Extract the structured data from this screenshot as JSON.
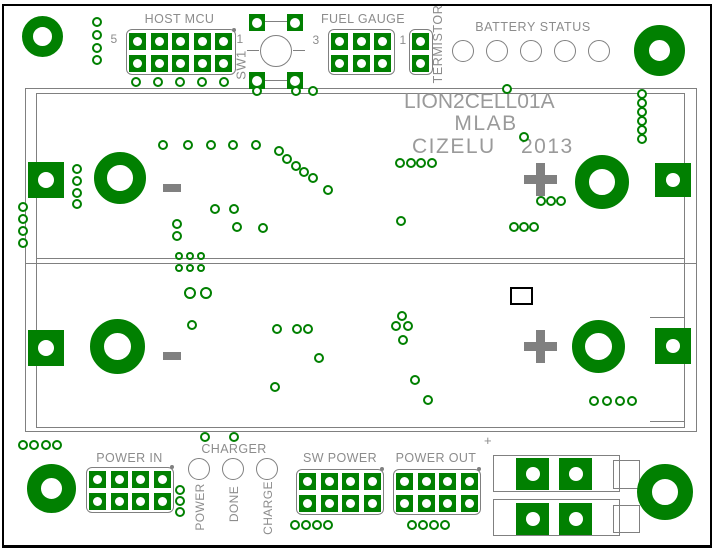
{
  "title_block": {
    "line1": "LION2CELL01A",
    "line2": "MLAB",
    "line3_name": "CIZELU",
    "line3_year": "2013"
  },
  "sections": {
    "host_mcu": {
      "label": "HOST MCU",
      "pin_left": "5",
      "pin_right": "1"
    },
    "fuel_gauge": {
      "label": "FUEL GAUGE",
      "pin_left": "3",
      "pin_right": "1"
    },
    "termistor": {
      "label": "TERMISTOR"
    },
    "switch": {
      "label": "SW1"
    },
    "battery_status": {
      "label": "BATTERY STATUS"
    },
    "charger": {
      "label": "CHARGER",
      "led_labels": [
        "POWER",
        "DONE",
        "CHARGE"
      ]
    },
    "power_in": {
      "label": "POWER IN"
    },
    "sw_power": {
      "label": "SW POWER"
    },
    "power_out": {
      "label": "POWER OUT"
    },
    "terminal": {
      "polarity": "+"
    }
  },
  "colors": {
    "copper": "#018001",
    "silkscreen": "#808080",
    "label_text": "#8c8c8c",
    "title_text": "#9a9a9a",
    "outline": "#000000"
  },
  "pcb": {
    "rects": [
      {
        "n": "battery-holder-outer",
        "x": 25,
        "y": 88,
        "w": 672,
        "h": 344
      },
      {
        "n": "battery-holder-inner",
        "x": 36,
        "y": 93,
        "w": 649,
        "h": 335
      },
      {
        "n": "terminal-block-row1",
        "x": 493,
        "y": 455,
        "w": 127,
        "h": 37
      },
      {
        "n": "terminal-block-row2",
        "x": 493,
        "y": 499,
        "w": 127,
        "h": 37
      },
      {
        "n": "terminal-tab-row1",
        "x": 613,
        "y": 460,
        "w": 27,
        "h": 29
      },
      {
        "n": "terminal-tab-row2",
        "x": 613,
        "y": 505,
        "w": 27,
        "h": 28
      },
      {
        "n": "component-outline",
        "x": 510,
        "y": 287,
        "w": 23,
        "h": 18,
        "c": "#000000",
        "lw": 2
      }
    ],
    "lines": [
      [
        36,
        258,
        649,
        1
      ],
      [
        25,
        263,
        672,
        1
      ],
      [
        650,
        317,
        34,
        1
      ],
      [
        650,
        421,
        34,
        1
      ],
      [
        265,
        21,
        24,
        1
      ],
      [
        265,
        80,
        24,
        1
      ],
      [
        247,
        50,
        12,
        1
      ],
      [
        293,
        50,
        12,
        1
      ]
    ],
    "circles": [
      {
        "n": "sw1-button",
        "cx": 276,
        "cy": 51,
        "r": 16
      },
      {
        "n": "battery-status-led",
        "cx": 463,
        "cy": 51,
        "r": 11
      },
      {
        "n": "battery-status-led",
        "cx": 497,
        "cy": 51,
        "r": 11
      },
      {
        "n": "battery-status-led",
        "cx": 531,
        "cy": 51,
        "r": 11
      },
      {
        "n": "battery-status-led",
        "cx": 565,
        "cy": 51,
        "r": 11
      },
      {
        "n": "battery-status-led",
        "cx": 599,
        "cy": 51,
        "r": 11
      },
      {
        "n": "charger-led-power",
        "cx": 199,
        "cy": 469,
        "r": 11
      },
      {
        "n": "charger-led-done",
        "cx": 233,
        "cy": 469,
        "r": 11
      },
      {
        "n": "charger-led-charge",
        "cx": 267,
        "cy": 469,
        "r": 11
      }
    ],
    "rings": [
      {
        "n": "mount-hole",
        "cx": 43,
        "cy": 37,
        "r": 21,
        "hole": 19
      },
      {
        "n": "mount-hole",
        "cx": 660,
        "cy": 51,
        "r": 26,
        "hole": 21
      },
      {
        "n": "mount-hole",
        "cx": 52,
        "cy": 489,
        "r": 25,
        "hole": 21
      },
      {
        "n": "mount-hole",
        "cx": 665,
        "cy": 492,
        "r": 28,
        "hole": 26
      },
      {
        "n": "battery-contact-ring",
        "cx": 120,
        "cy": 178,
        "r": 26,
        "hole": 26
      },
      {
        "n": "battery-contact-ring",
        "cx": 118,
        "cy": 347,
        "r": 28,
        "hole": 27
      },
      {
        "n": "battery-contact-ring",
        "cx": 602,
        "cy": 182,
        "r": 27,
        "hole": 26
      },
      {
        "n": "battery-contact-ring",
        "cx": 599,
        "cy": 347,
        "r": 27,
        "hole": 27
      }
    ],
    "square_pads": [
      {
        "n": "battery1-neg-pad",
        "x": 28,
        "y": 162,
        "w": 36,
        "h": 36,
        "hole": 16
      },
      {
        "n": "battery2-neg-pad",
        "x": 28,
        "y": 330,
        "w": 36,
        "h": 36,
        "hole": 16
      },
      {
        "n": "battery1-pos-pad",
        "x": 655,
        "y": 163,
        "w": 36,
        "h": 34,
        "hole": 14
      },
      {
        "n": "battery2-pos-pad",
        "x": 655,
        "y": 328,
        "w": 36,
        "h": 36,
        "hole": 14
      },
      {
        "n": "sw1-pad",
        "x": 249,
        "y": 14,
        "w": 16,
        "h": 17,
        "hole": 10
      },
      {
        "n": "sw1-pad",
        "x": 287,
        "y": 14,
        "w": 16,
        "h": 17,
        "hole": 10
      },
      {
        "n": "sw1-pad",
        "x": 249,
        "y": 72,
        "w": 16,
        "h": 17,
        "hole": 10
      },
      {
        "n": "sw1-pad",
        "x": 287,
        "y": 72,
        "w": 16,
        "h": 17,
        "hole": 10
      }
    ],
    "terminal_pads": [
      {
        "x": 516,
        "y": 458
      },
      {
        "x": 559,
        "y": 458
      },
      {
        "x": 516,
        "y": 503
      },
      {
        "x": 559,
        "y": 503
      }
    ],
    "headers": [
      {
        "n": "host-mcu-header",
        "x": 126,
        "y": 29,
        "cols": 5,
        "dot": [
          232,
          28
        ]
      },
      {
        "n": "fuel-gauge-header",
        "x": 328,
        "y": 29,
        "cols": 3
      },
      {
        "n": "termistor-header",
        "x": 409,
        "y": 29,
        "cols": 1
      },
      {
        "n": "power-in-header",
        "x": 86,
        "y": 467,
        "cols": 4,
        "dot": [
          170,
          465
        ]
      },
      {
        "n": "sw-power-header",
        "x": 296,
        "y": 469,
        "cols": 4,
        "dot": [
          380,
          467
        ]
      },
      {
        "n": "power-out-header",
        "x": 393,
        "y": 469,
        "cols": 4,
        "dot": [
          477,
          467
        ]
      }
    ],
    "polarity_symbols": [
      {
        "n": "battery1-minus-symbol",
        "t": "minus",
        "x": 163,
        "y": 184
      },
      {
        "n": "battery1-plus-symbol",
        "t": "plus",
        "x": 524,
        "y": 163
      },
      {
        "n": "battery2-minus-symbol",
        "t": "minus",
        "x": 163,
        "y": 352
      },
      {
        "n": "battery2-plus-symbol",
        "t": "plus",
        "x": 524,
        "y": 330
      }
    ],
    "vias": [
      [
        97,
        22
      ],
      [
        97,
        35
      ],
      [
        97,
        48
      ],
      [
        97,
        60
      ],
      [
        136,
        82
      ],
      [
        158,
        82
      ],
      [
        180,
        82
      ],
      [
        202,
        82
      ],
      [
        224,
        82
      ],
      [
        257,
        91
      ],
      [
        296,
        91
      ],
      [
        313,
        91
      ],
      [
        507,
        89
      ],
      [
        642,
        94
      ],
      [
        642,
        103
      ],
      [
        642,
        112
      ],
      [
        642,
        121
      ],
      [
        642,
        130
      ],
      [
        642,
        139
      ],
      [
        163,
        145
      ],
      [
        188,
        145
      ],
      [
        211,
        145
      ],
      [
        233,
        145
      ],
      [
        256,
        145
      ],
      [
        279,
        151
      ],
      [
        287,
        159
      ],
      [
        296,
        166
      ],
      [
        304,
        172
      ],
      [
        313,
        178
      ],
      [
        328,
        190
      ],
      [
        400,
        163
      ],
      [
        411,
        163
      ],
      [
        421,
        163
      ],
      [
        432,
        163
      ],
      [
        524,
        137
      ],
      [
        541,
        201
      ],
      [
        551,
        201
      ],
      [
        561,
        201
      ],
      [
        514,
        227
      ],
      [
        524,
        227
      ],
      [
        534,
        227
      ],
      [
        215,
        209
      ],
      [
        234,
        209
      ],
      [
        177,
        224
      ],
      [
        177,
        236
      ],
      [
        237,
        227
      ],
      [
        263,
        228
      ],
      [
        401,
        221
      ],
      [
        77,
        169
      ],
      [
        77,
        181
      ],
      [
        77,
        193
      ],
      [
        77,
        204
      ],
      [
        23,
        207
      ],
      [
        23,
        219
      ],
      [
        23,
        231
      ],
      [
        23,
        243
      ],
      [
        179,
        256,
        8
      ],
      [
        190,
        256,
        8
      ],
      [
        201,
        256,
        8
      ],
      [
        179,
        268,
        8
      ],
      [
        190,
        268,
        8
      ],
      [
        201,
        268,
        8
      ],
      [
        190,
        293,
        12
      ],
      [
        206,
        293,
        12
      ],
      [
        192,
        325
      ],
      [
        277,
        329
      ],
      [
        297,
        329
      ],
      [
        308,
        329
      ],
      [
        319,
        358
      ],
      [
        275,
        387
      ],
      [
        402,
        316
      ],
      [
        396,
        326
      ],
      [
        408,
        326
      ],
      [
        403,
        340
      ],
      [
        415,
        380
      ],
      [
        428,
        400
      ],
      [
        594,
        401
      ],
      [
        607,
        401
      ],
      [
        620,
        401
      ],
      [
        632,
        401
      ],
      [
        23,
        445
      ],
      [
        34,
        445
      ],
      [
        46,
        445
      ],
      [
        57,
        445
      ],
      [
        205,
        437
      ],
      [
        234,
        437
      ],
      [
        180,
        490
      ],
      [
        180,
        501
      ],
      [
        180,
        512
      ],
      [
        295,
        525
      ],
      [
        306,
        525
      ],
      [
        317,
        525
      ],
      [
        328,
        525
      ],
      [
        412,
        525
      ],
      [
        423,
        525
      ],
      [
        434,
        525
      ],
      [
        445,
        525
      ]
    ]
  }
}
